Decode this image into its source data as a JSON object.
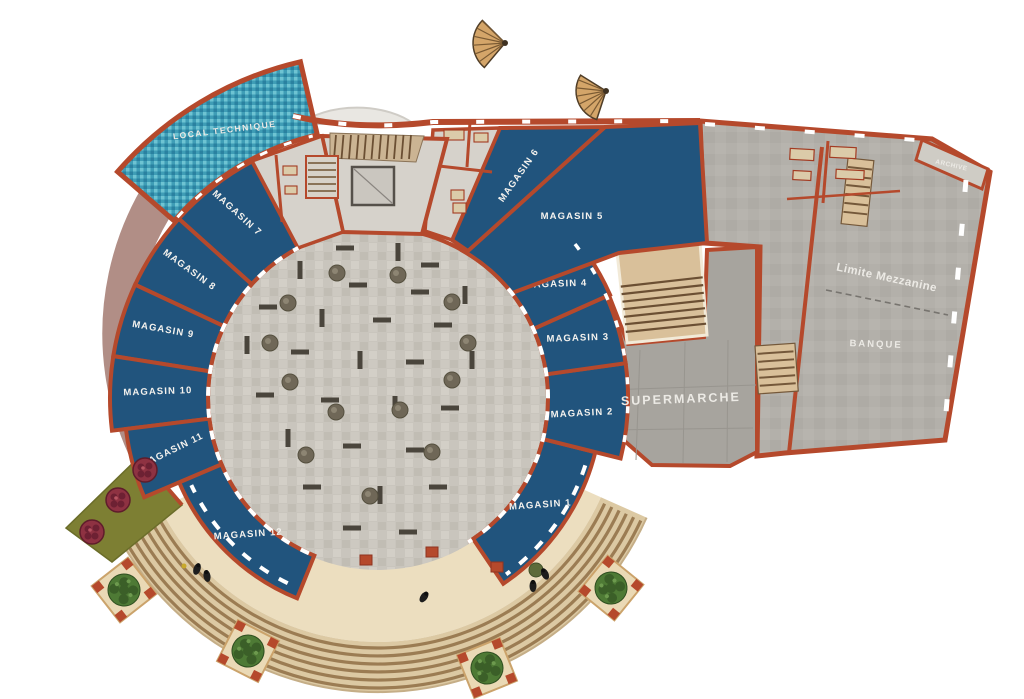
{
  "plan": {
    "stores": {
      "magasin_1": "MAGASIN 1",
      "magasin_2": "MAGASIN 2",
      "magasin_3": "MAGASIN 3",
      "magasin_4": "MAGASIN 4",
      "magasin_5": "MAGASIN 5",
      "magasin_6": "MAGASIN 6",
      "magasin_7": "MAGASIN 7",
      "magasin_8": "MAGASIN 8",
      "magasin_9": "MAGASIN 9",
      "magasin_10": "MAGASIN 10",
      "magasin_11": "MAGASIN 11",
      "magasin_12": "MAGASIN 12"
    },
    "areas": {
      "local_technique": "LOCAL TECHNIQUE",
      "supermarche": "SUPERMARCHE",
      "banque": "BANQUE",
      "limite_mezzanine": "Limite Mezzanine",
      "archive": "ARCHIVE"
    },
    "colors": {
      "wall": "#b5492c",
      "store_blue": "#21547d",
      "pool_teal": "#3f9db6",
      "plaza_gray": "#c9c5bd",
      "hall_gray": "#b3b0aa",
      "supermarket_gray": "#a7a49e",
      "promenade_cream": "#ecdebf",
      "steps_tan": "#dcc9a3",
      "crescent_mauve": "#b18e86",
      "garden_olive": "#7d7f33",
      "shrub_green": "#4e7a35",
      "label_text": "#f4f2ee"
    }
  }
}
